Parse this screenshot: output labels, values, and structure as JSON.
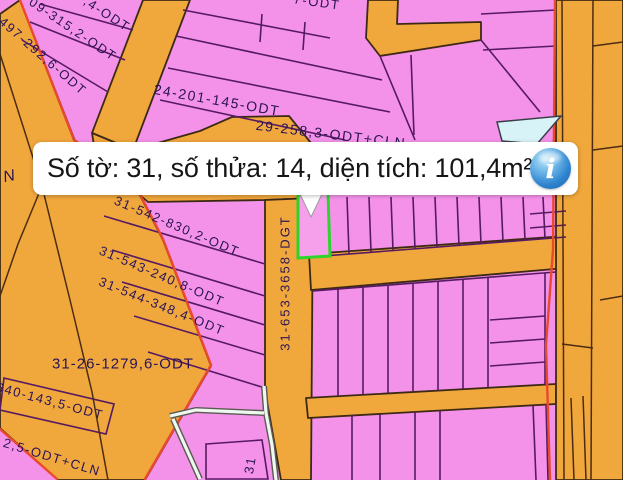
{
  "popup": {
    "text": "Số tờ: 31, số thửa: 14, diện tích: 101,4m²",
    "info_icon_glyph": "i"
  },
  "map": {
    "labels": {
      "wedge_partial": ",4-ODT",
      "wedge_09": "09-315,2-ODT",
      "wedge_497": "497-292,6-ODT",
      "parcel_24": "24-201-145-ODT",
      "parcel_29": "29-258,3-ODT+CLN",
      "parcel_542": "31-542-830,2-ODT",
      "parcel_543": "31-543-240,8-ODT",
      "parcel_544": "31-544-348,4-ODT",
      "parcel_26": "31-26-1279,6-ODT",
      "parcel_640": "640-143,5-ODT",
      "parcel_25cln": "2,5-ODT+CLN",
      "road_dgt": "31-653-3658-DGT",
      "letter_n": "N",
      "parcel_31_partial": "31",
      "top_partial": "7-ODT"
    },
    "colors": {
      "parcel_pink": "#f492ea",
      "road_orange": "#f0a73c",
      "boundary_red": "#ea4a2c",
      "parcel_line_purple": "#561a62",
      "selection_green": "#2ed32e",
      "water_cyan": "#d8f3f8",
      "info_icon_blue": "#2f84cf"
    }
  }
}
